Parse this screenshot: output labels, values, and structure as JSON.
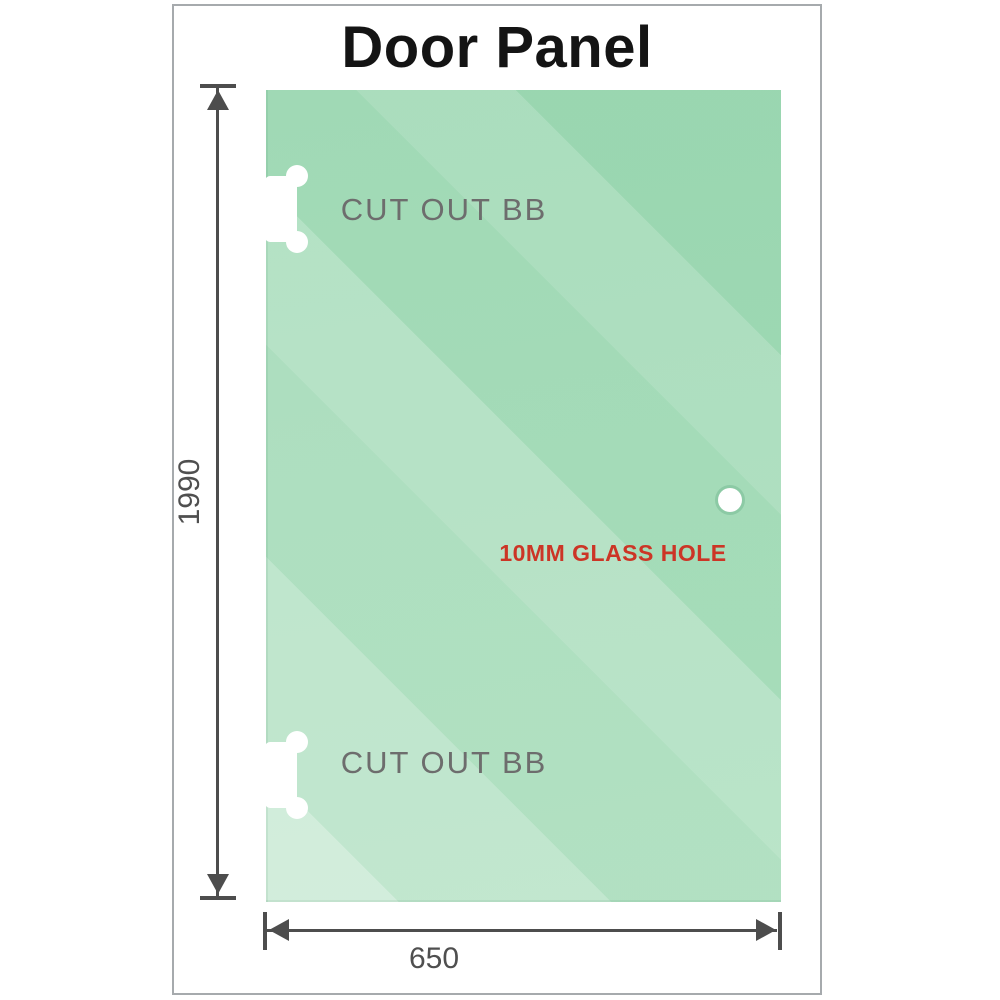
{
  "title": "Door Panel",
  "panel": {
    "cutout_top_label": "CUT OUT BB",
    "cutout_bottom_label": "CUT OUT BB",
    "hole_label": "10MM GLASS HOLE"
  },
  "dimensions": {
    "height_label": "1990",
    "width_label": "650"
  },
  "colors": {
    "glass_base": "#93d4ab",
    "glass_light": "#cfeedd",
    "dimension": "#4d4d4d",
    "dim_label": "#4f4f4f",
    "cutout_label": "#6d6d6d",
    "hole_label": "#cc3526",
    "page_border": "#a6aaad"
  }
}
